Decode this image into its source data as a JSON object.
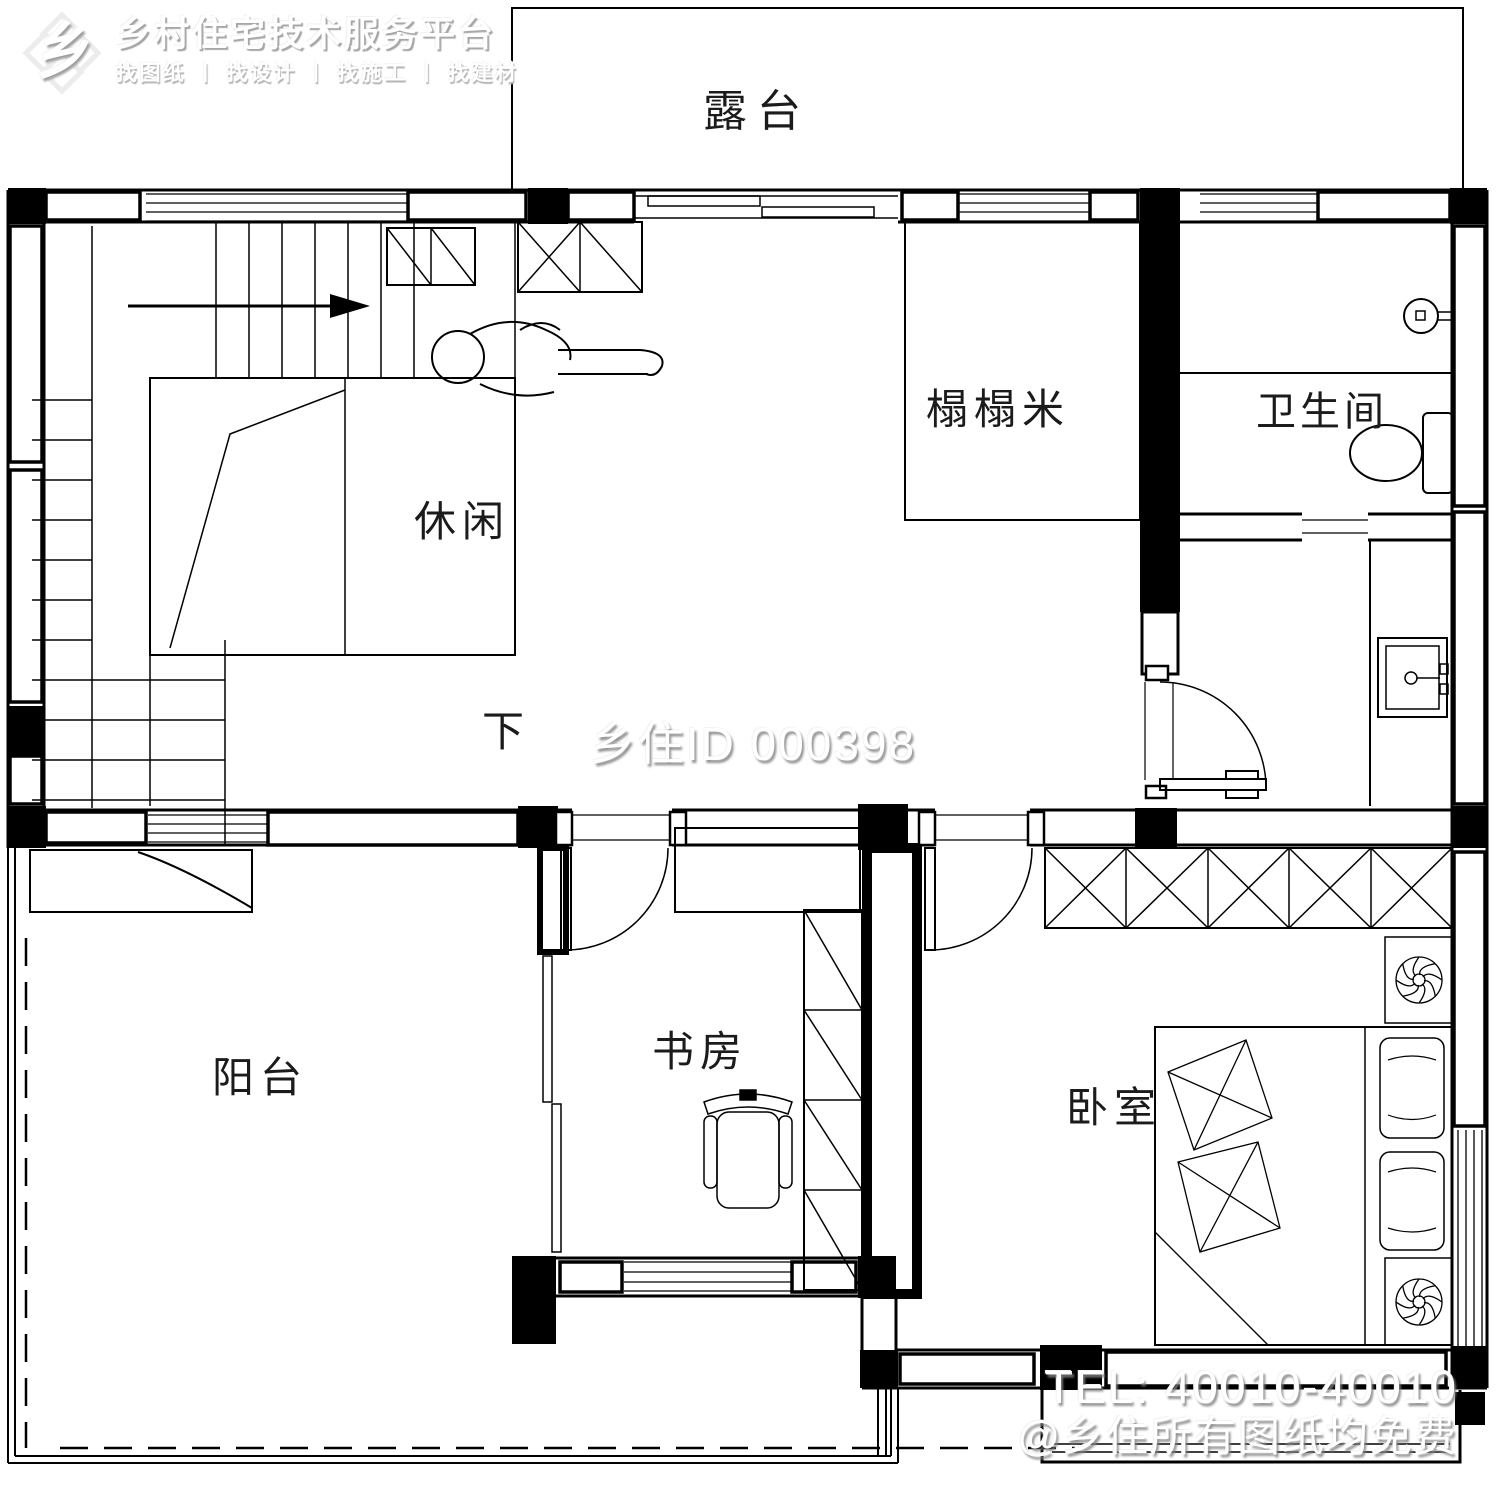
{
  "logo": {
    "title": "乡村住宅技术服务平台",
    "subtitle": "找图纸 丨 找设计 丨 找施工 丨 找建材",
    "glyph": "乡"
  },
  "plan": {
    "rooms": {
      "terrace": "露台",
      "tatami": "榻榻米",
      "bathroom": "卫生间",
      "leisure": "休闲",
      "down": "下",
      "balcony": "阳台",
      "study": "书房",
      "bedroom": "卧室"
    }
  },
  "watermarks": {
    "center_id": "乡住ID 000398",
    "tel": "TEL: 40010-40010",
    "free_note": "@乡住所有图纸均免费"
  },
  "colors": {
    "line": "#000000",
    "watermark_text": "#ffffff",
    "watermark_shadow": "#828282"
  }
}
